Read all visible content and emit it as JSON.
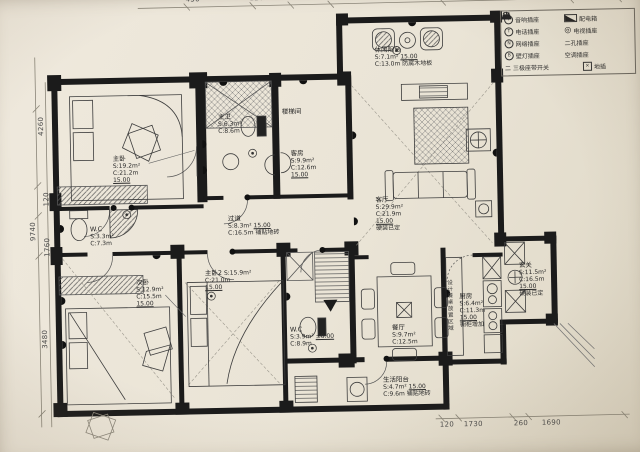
{
  "legend": {
    "rows": [
      {
        "l_symbol": "Y",
        "l_label": "音响插座",
        "r_label": "配电箱"
      },
      {
        "l_symbol": "T",
        "l_label": "电话插座",
        "r_symbol": "◎",
        "r_label": "电视插座"
      },
      {
        "l_symbol": "N",
        "l_label": "网络插座",
        "r_label": "二孔插座"
      },
      {
        "l_symbol": "B",
        "l_label": "壁灯插座",
        "r_label": "空调插座"
      },
      {
        "l_label": "二 三极座带开关",
        "r_symbol": "×",
        "r_label": "地插"
      }
    ]
  },
  "rooms": {
    "master": {
      "name": "主卧",
      "area": "S:19.2m²",
      "perimeter": "C:21.2m",
      "level": "15.00"
    },
    "master_bath": {
      "name": "主卫",
      "area": "S:6.3m²",
      "perimeter": "C:8.6m"
    },
    "stair": {
      "name": "楼梯间"
    },
    "guest": {
      "name": "客房",
      "area": "S:9.9m²",
      "perimeter": "C:12.6m",
      "level": "15.00"
    },
    "leisure_balcony": {
      "name": "休闲阳台",
      "area": "S:7.1m²",
      "level": "15.00",
      "perimeter": "C:13.0m",
      "note": "防腐木地板"
    },
    "living": {
      "name": "客厅",
      "area": "S:29.9m²",
      "perimeter": "C:21.9m",
      "level": "15.00",
      "note": "硬装已定"
    },
    "hallway": {
      "name": "过道",
      "area": "S:8.3m²",
      "level": "15.00",
      "perimeter": "C:16.5m",
      "note": "铺贴地砖"
    },
    "wc": {
      "name": "W.C",
      "area": "S:3.3m²",
      "perimeter": "C:7.3m"
    },
    "bedroom2": {
      "name": "次卧",
      "area": "S:12.9m²",
      "perimeter": "C:15.5m",
      "level": "15.00"
    },
    "master2": {
      "name": "主卧2",
      "area": "S:15.9m²",
      "perimeter": "C:21.0m",
      "level": "15.00"
    },
    "guest_bath": {
      "name": "W.C",
      "area": "S:3.9m²",
      "level": "±0.00",
      "perimeter": "C:8.9m"
    },
    "dining": {
      "name": "餐厅",
      "area": "S:9.7m²",
      "perimeter": "C:12.5m"
    },
    "kitchen": {
      "name": "厨房",
      "area": "S:6.4m²",
      "perimeter": "C:11.3m",
      "level": "15.00",
      "note": "橱柜增加"
    },
    "entry": {
      "name": "玄关",
      "area": "S:11.5m²",
      "perimeter": "C:16.5m",
      "level": "15.00",
      "note": "硬装已定"
    },
    "service_balcony": {
      "name": "生活阳台",
      "area": "S:4.7m²",
      "level": "15.00",
      "perimeter": "C:9.6m",
      "note": "铺贴地砖"
    },
    "dining_note": "设计餐桌放置区域"
  },
  "dimensions": {
    "top": [
      "450",
      "120",
      "4500",
      "320",
      "4700",
      "280"
    ],
    "left": [
      "4260",
      "120",
      "9740",
      "1760",
      "3480"
    ],
    "bottom": [
      "120",
      "1730",
      "260",
      "1690"
    ]
  }
}
